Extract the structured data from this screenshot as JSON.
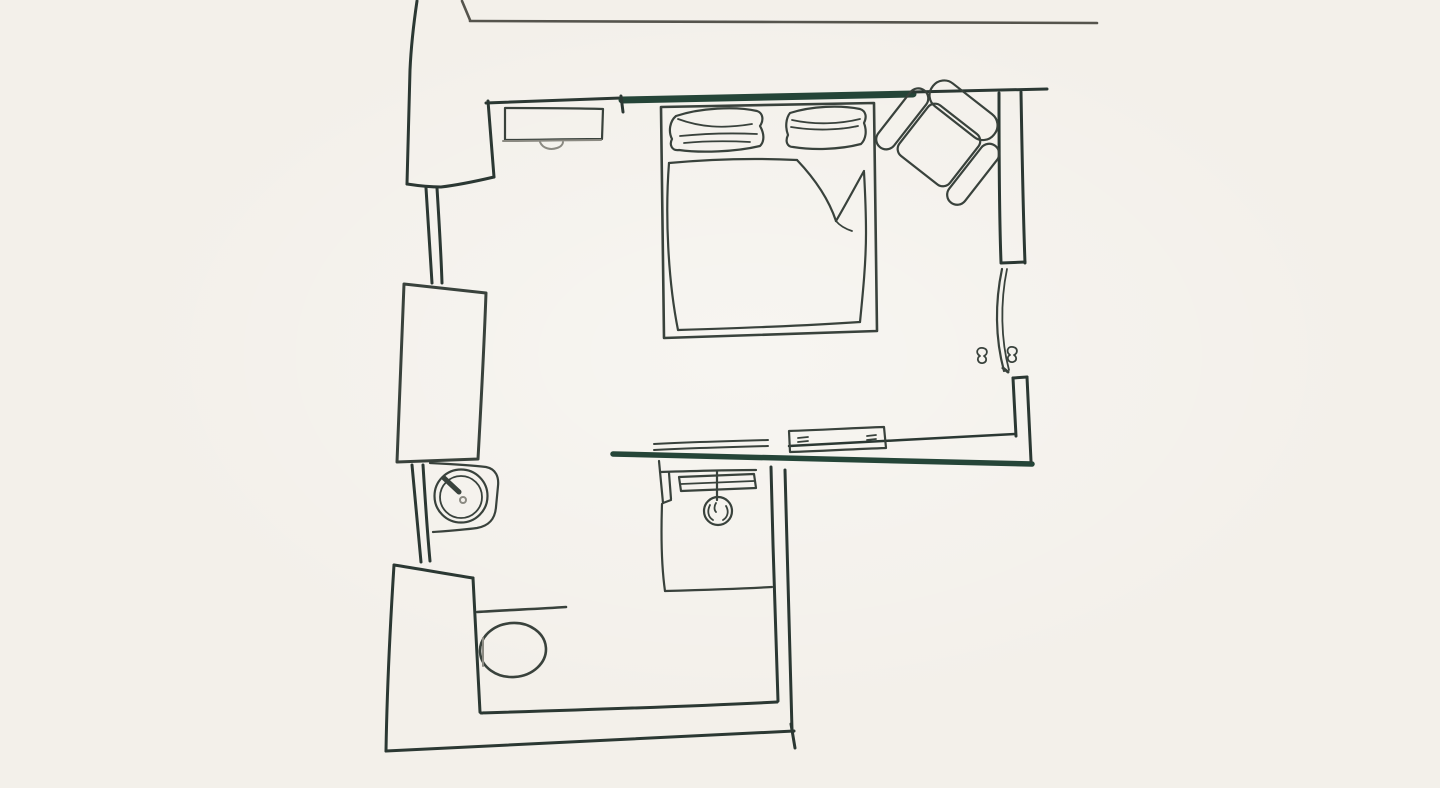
{
  "scene": {
    "title": "Hand-drawn floor plan sketch of a bedroom with en-suite bathroom",
    "colors": {
      "background": "#f3f0ea",
      "ink": "#39423c",
      "wall": "#2b3833",
      "wall_accent": "#254538",
      "neighbor_gray": "#55544d",
      "soft_gray": "#8b8a82"
    },
    "elements": [
      {
        "id": "neighbor-structure",
        "label": "Adjacent structure wall lines (light gray, top)"
      },
      {
        "id": "walls",
        "label": "Exterior and interior walls of the room"
      },
      {
        "id": "entry-door",
        "label": "Entry door leaf with handle and jamb"
      },
      {
        "id": "desk",
        "label": "Desk / dresser with drawer handle"
      },
      {
        "id": "bed",
        "label": "Double bed with frame, two pillows and duvet with folded corner"
      },
      {
        "id": "armchair",
        "label": "Armchair with back cushion and two armrests"
      },
      {
        "id": "wardrobe",
        "label": "Wardrobe / closet block"
      },
      {
        "id": "sink",
        "label": "Round sink with faucet on curved counter"
      },
      {
        "id": "toilet",
        "label": "Toilet with oval bowl"
      },
      {
        "id": "shower",
        "label": "Shower stall with sliding-door track and shower head"
      },
      {
        "id": "radiator",
        "label": "Radiator / shelf box on dividing wall"
      },
      {
        "id": "towel-bar",
        "label": "Towel bar double lines"
      }
    ]
  }
}
